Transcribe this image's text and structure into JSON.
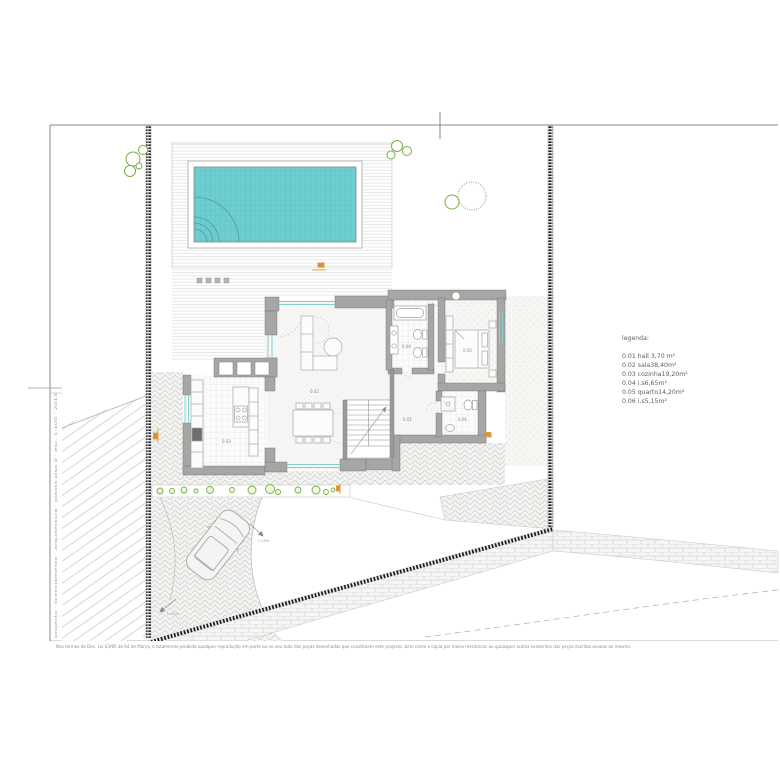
{
  "legend": {
    "title": "legenda:",
    "items": [
      "0.01 hall 3,70 m²",
      "0.02 sala38,40m²",
      "0.03 cozinha19,20m²",
      "0.04 i.s6,65m²",
      "0.05 quarto14,20m²",
      "0.06 i.s5,15m²"
    ]
  },
  "rooms": {
    "hall": "0.01",
    "sala": "0.02",
    "cozinha": "0.03",
    "is_top": "0.04",
    "quarto": "0.05",
    "is_bottom": "0.06"
  },
  "annotations": {
    "slope_a": "i=10%",
    "slope_b": "i=10%"
  },
  "footer": {
    "disclaimer": "Nos termos do Dec. Lei 63/85 de 04 de Março, é totalmente proibida qualquer reprodução em parte ou no seu todo das peças desenhadas que constituem este projecto, bem como a cópia por meios mecânicos ou quaisquer outros existentes das peças escritas anexas ao mesmo."
  },
  "margin": {
    "vertical_text": "projecto · licenciamento · arquitectura · planta piso 0 · esc. 1:100 · 2013"
  },
  "colors": {
    "pool": "#6ecdd0",
    "green": "#76b041",
    "orange": "#e0912f",
    "wall_gray": "#a6a6a4",
    "boundary_black": "#1c1c1c",
    "glazing_teal": "#7fd0d0"
  }
}
